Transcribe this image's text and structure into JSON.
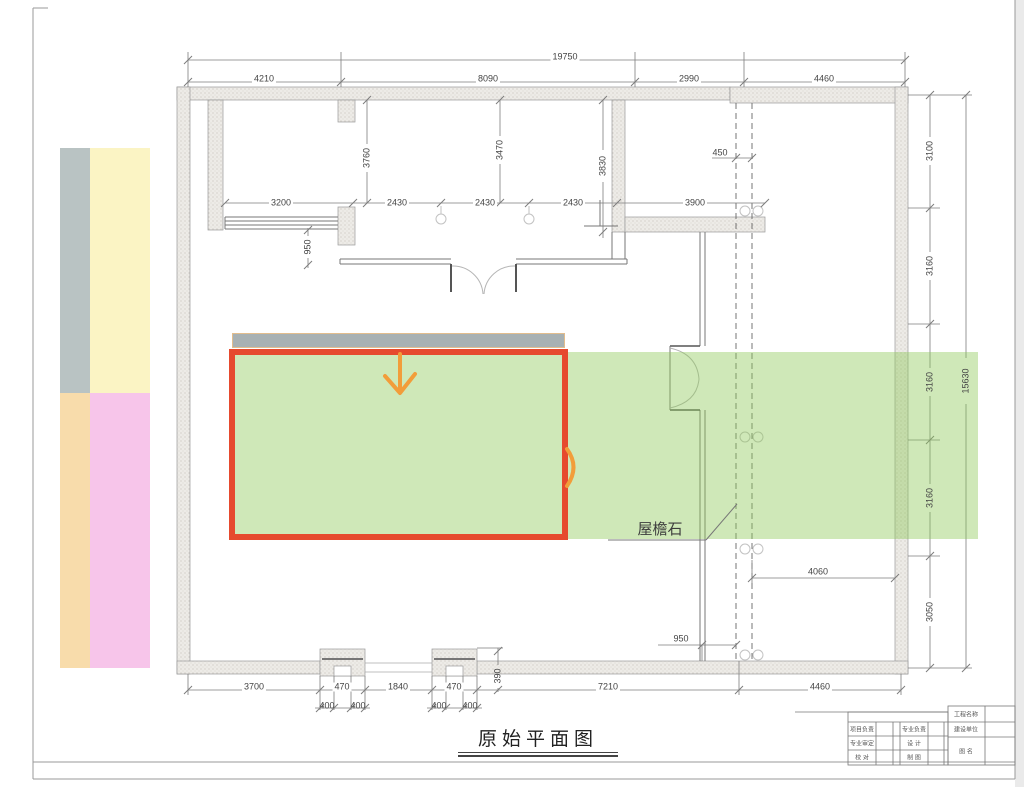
{
  "page": {
    "title": "原始平面图",
    "eave_label": "屋檐石"
  },
  "colors": {
    "highlight_green": "rgba(140,200,85,0.42)",
    "annotation_red": "#e64a2e",
    "annotation_orange": "#f29d3a",
    "gray_bar": "#a8b1b3",
    "legend_gray": "#b9c3c3",
    "legend_yellow": "#fbf4c4",
    "legend_peach": "#f8dcab",
    "legend_pink": "#f7c5ea"
  },
  "legend_bars": [
    {
      "name": "legend-bar-gray",
      "color": "#b9c3c3",
      "x": 60,
      "y": 148,
      "w": 30,
      "h": 245
    },
    {
      "name": "legend-bar-yellow",
      "color": "#fbf4c4",
      "x": 90,
      "y": 148,
      "w": 60,
      "h": 245
    },
    {
      "name": "legend-bar-peach",
      "color": "#f8dcab",
      "x": 60,
      "y": 393,
      "w": 30,
      "h": 275
    },
    {
      "name": "legend-bar-pink",
      "color": "#f7c5ea",
      "x": 90,
      "y": 393,
      "w": 60,
      "h": 275
    }
  ],
  "dimensions": [
    {
      "t": "19750",
      "x": 565,
      "y": 57,
      "bg": true
    },
    {
      "t": "4210",
      "x": 264,
      "y": 79,
      "bg": true
    },
    {
      "t": "8090",
      "x": 488,
      "y": 79,
      "bg": true
    },
    {
      "t": "2990",
      "x": 689,
      "y": 79,
      "bg": true
    },
    {
      "t": "4460",
      "x": 824,
      "y": 79,
      "bg": true
    },
    {
      "t": "3200",
      "x": 281,
      "y": 203,
      "bg": true
    },
    {
      "t": "2430",
      "x": 397,
      "y": 203,
      "bg": true
    },
    {
      "t": "2430",
      "x": 485,
      "y": 203,
      "bg": true
    },
    {
      "t": "2430",
      "x": 573,
      "y": 203,
      "bg": true
    },
    {
      "t": "3900",
      "x": 695,
      "y": 203,
      "bg": true
    },
    {
      "t": "450",
      "x": 720,
      "y": 153,
      "bg": true
    },
    {
      "t": "3760",
      "x": 367,
      "y": 158,
      "rot": true
    },
    {
      "t": "3470",
      "x": 500,
      "y": 150,
      "rot": true
    },
    {
      "t": "3830",
      "x": 603,
      "y": 166,
      "rot": true
    },
    {
      "t": "950",
      "x": 308,
      "y": 247,
      "rot": true
    },
    {
      "t": "3100",
      "x": 930,
      "y": 151,
      "rot": true
    },
    {
      "t": "3160",
      "x": 930,
      "y": 266,
      "rot": true
    },
    {
      "t": "3160",
      "x": 930,
      "y": 382,
      "rot": true
    },
    {
      "t": "3160",
      "x": 930,
      "y": 498,
      "rot": true
    },
    {
      "t": "3050",
      "x": 930,
      "y": 612,
      "rot": true
    },
    {
      "t": "15630",
      "x": 966,
      "y": 381,
      "rot": true
    },
    {
      "t": "4060",
      "x": 818,
      "y": 572,
      "bg": true
    },
    {
      "t": "950",
      "x": 681,
      "y": 639,
      "bg": true
    },
    {
      "t": "390",
      "x": 498,
      "y": 676,
      "rot": true
    },
    {
      "t": "3700",
      "x": 254,
      "y": 687,
      "bg": true
    },
    {
      "t": "470",
      "x": 342,
      "y": 687,
      "bg": true
    },
    {
      "t": "1840",
      "x": 398,
      "y": 687,
      "bg": true
    },
    {
      "t": "470",
      "x": 454,
      "y": 687,
      "bg": true
    },
    {
      "t": "7210",
      "x": 608,
      "y": 687,
      "bg": true
    },
    {
      "t": "4460",
      "x": 820,
      "y": 687,
      "bg": true
    },
    {
      "t": "400",
      "x": 327,
      "y": 706
    },
    {
      "t": "400",
      "x": 358,
      "y": 706
    },
    {
      "t": "400",
      "x": 439,
      "y": 706
    },
    {
      "t": "400",
      "x": 470,
      "y": 706
    }
  ],
  "title_block": {
    "cells": [
      {
        "text": "工程名称",
        "x": 966,
        "y": 714
      },
      {
        "text": "项目负责",
        "x": 862,
        "y": 729
      },
      {
        "text": "专业负责",
        "x": 914,
        "y": 729
      },
      {
        "text": "建设单位",
        "x": 966,
        "y": 729
      },
      {
        "text": "专业审定",
        "x": 862,
        "y": 743
      },
      {
        "text": "设  计",
        "x": 914,
        "y": 743
      },
      {
        "text": "图  名",
        "x": 966,
        "y": 751
      },
      {
        "text": "校  对",
        "x": 862,
        "y": 757
      },
      {
        "text": "制  图",
        "x": 914,
        "y": 757
      }
    ]
  }
}
